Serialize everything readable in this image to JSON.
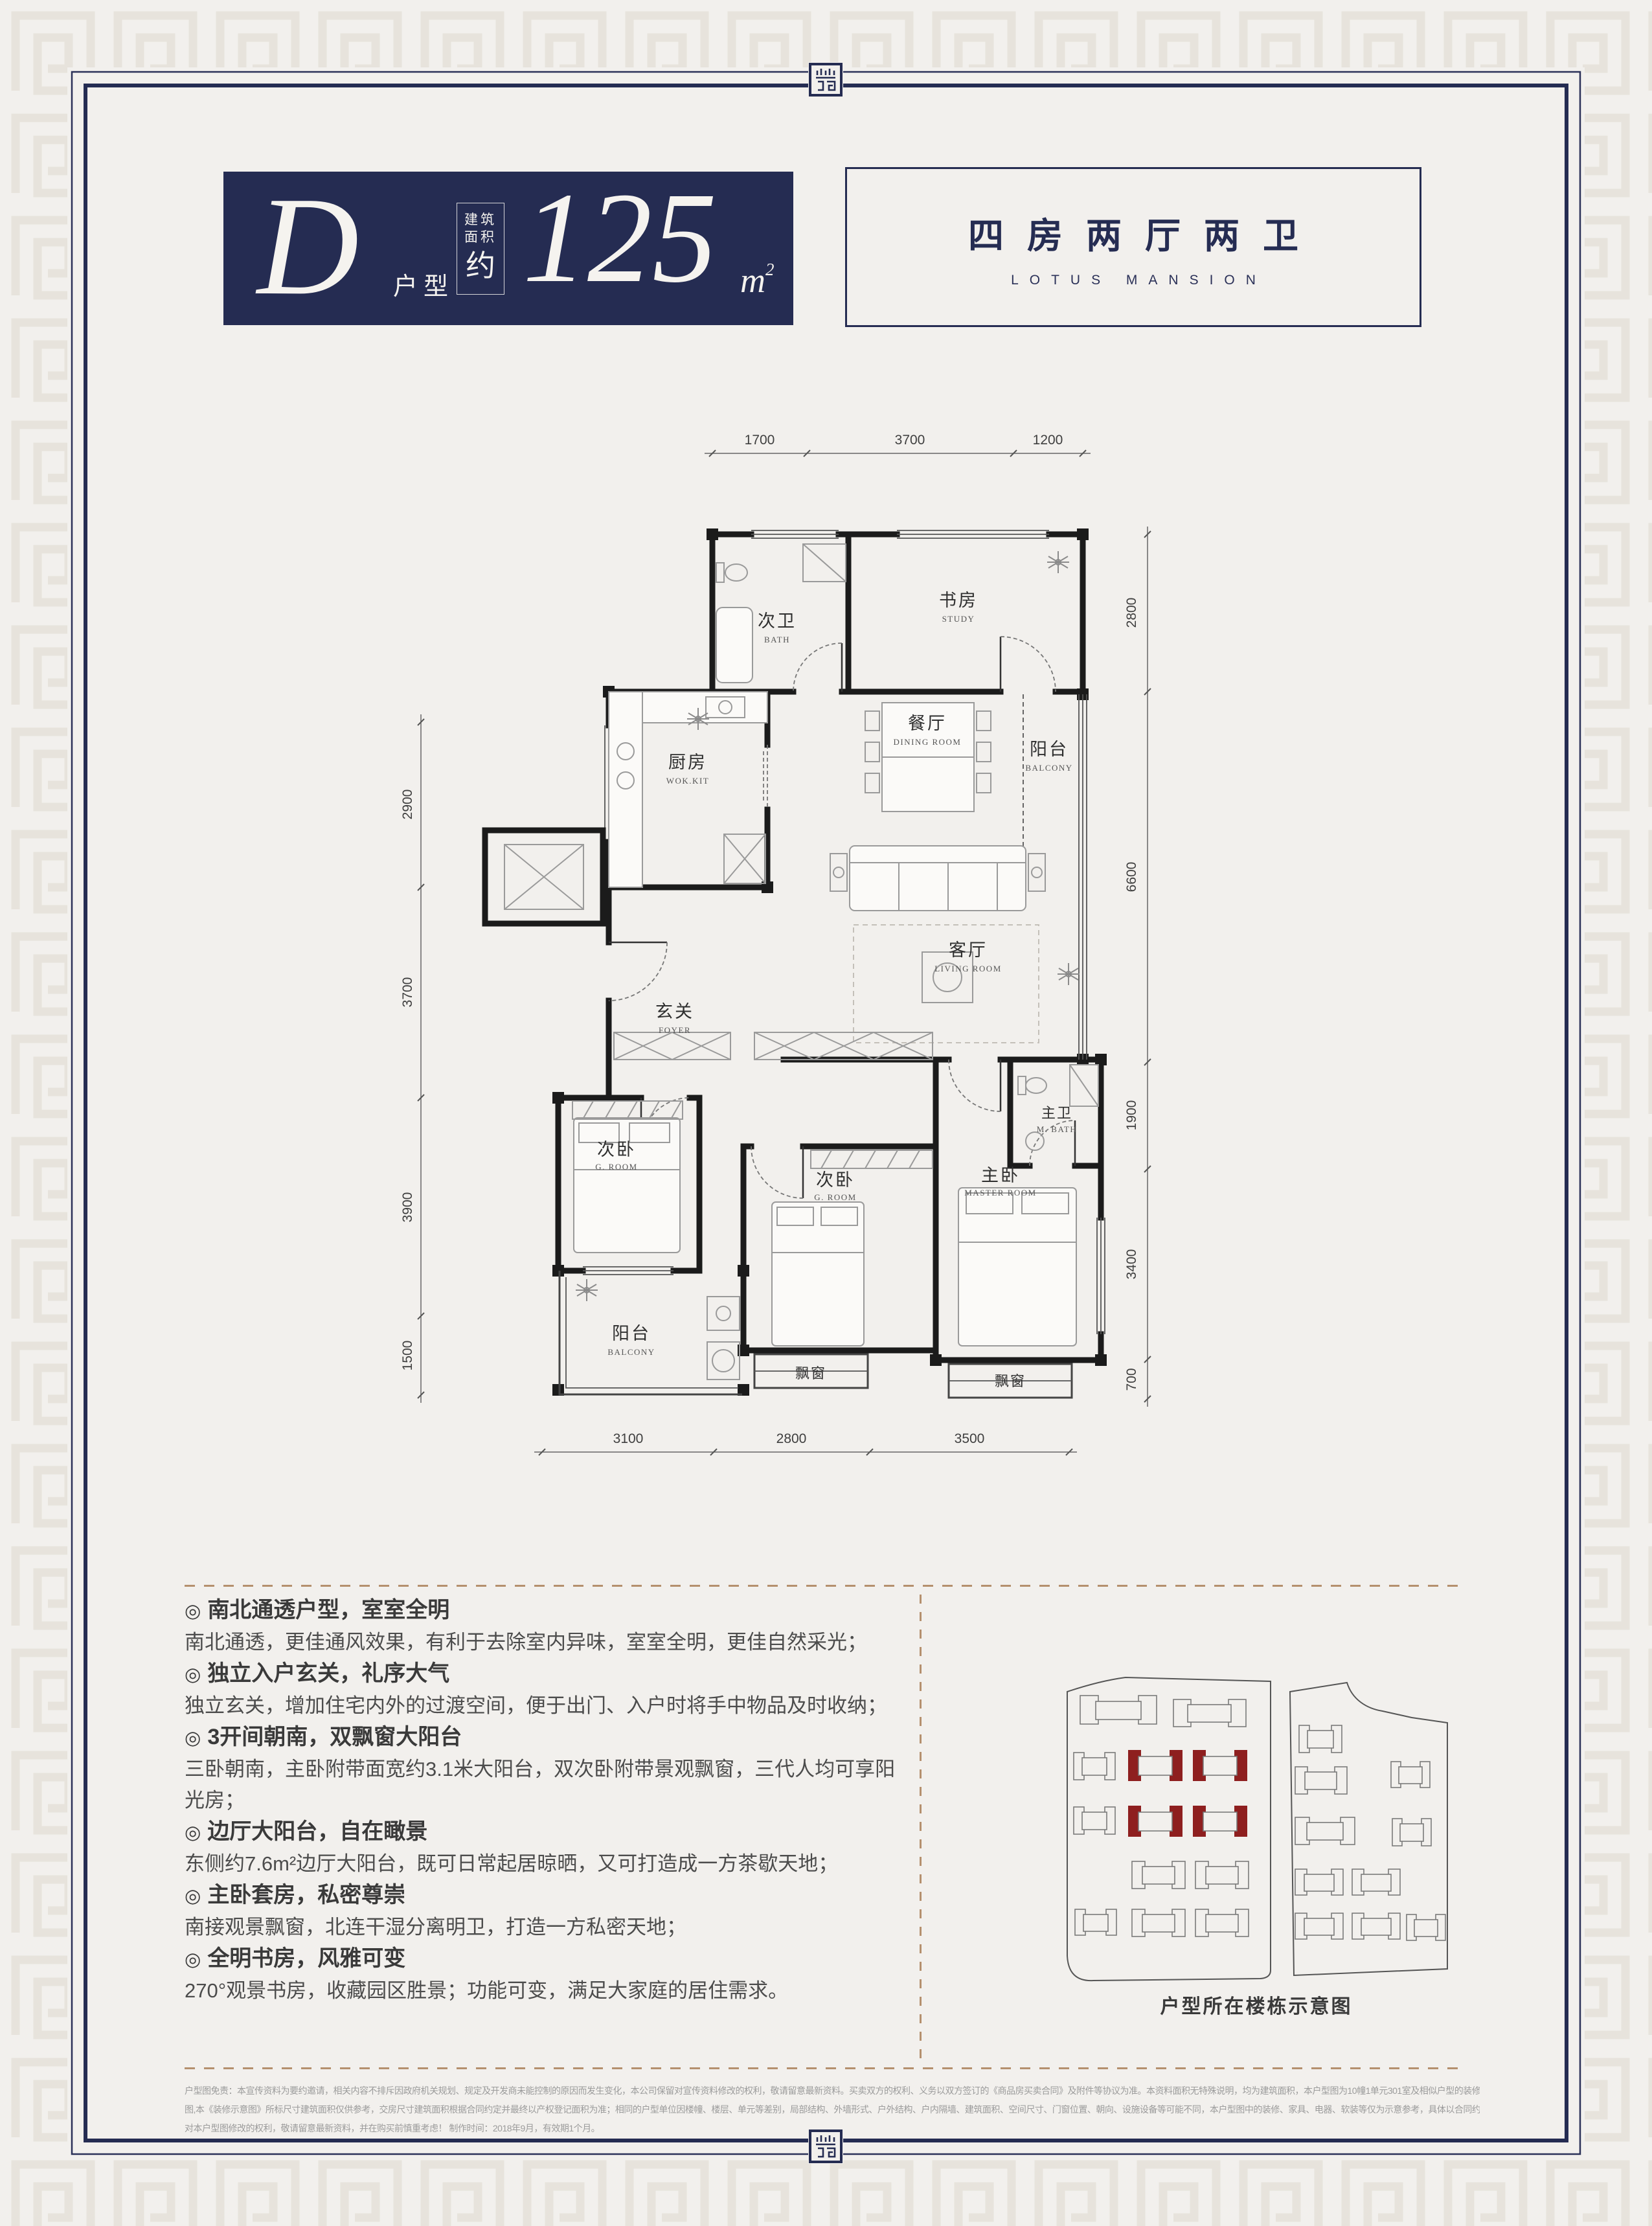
{
  "colors": {
    "navy": "#252c52",
    "page_bg": "#f2f0ed",
    "pattern": "#e7e3dc",
    "highlight_red": "#8e1f1f",
    "dash_tan": "#b5906e"
  },
  "header": {
    "unit_letter": "D",
    "unit_label": "户型",
    "area_box": {
      "line1": "建筑",
      "line2": "面积",
      "line3": "约"
    },
    "area_value": "125",
    "area_unit_base": "m",
    "area_unit_sup": "2",
    "layout_title": "四房两厅两卫",
    "layout_subtitle": "LOTUS MANSION"
  },
  "plan": {
    "rooms": [
      {
        "cn": "次卫",
        "en": "BATH"
      },
      {
        "cn": "书房",
        "en": "STUDY"
      },
      {
        "cn": "厨房",
        "en": "WOK.KIT"
      },
      {
        "cn": "餐厅",
        "en": "DINING ROOM"
      },
      {
        "cn": "阳台",
        "en": "BALCONY"
      },
      {
        "cn": "客厅",
        "en": "LIVING ROOM"
      },
      {
        "cn": "玄关",
        "en": "FOYER"
      },
      {
        "cn": "次卧",
        "en": "G. ROOM"
      },
      {
        "cn": "次卧",
        "en": "G. ROOM"
      },
      {
        "cn": "主卧",
        "en": "MASTER ROOM"
      },
      {
        "cn": "主卫",
        "en": "M. BATH"
      },
      {
        "cn": "阳台",
        "en": "BALCONY"
      }
    ],
    "bay_window": "飘窗",
    "dims": {
      "top": [
        "1700",
        "3700",
        "1200"
      ],
      "right": [
        "2800",
        "6600",
        "1900",
        "3400",
        "700"
      ],
      "bottom": [
        "3100",
        "2800",
        "3500"
      ],
      "left": [
        "2900",
        "3700",
        "3900",
        "1500"
      ]
    }
  },
  "marker": "◎",
  "features": [
    {
      "heading": "南北通透户型，室室全明",
      "body": "南北通透，更佳通风效果，有利于去除室内异味，室室全明，更佳自然采光；"
    },
    {
      "heading": "独立入户玄关，礼序大气",
      "body": "独立玄关，增加住宅内外的过渡空间，便于出门、入户时将手中物品及时收纳；"
    },
    {
      "heading": "3开间朝南，双飘窗大阳台",
      "body": "三卧朝南，主卧附带面宽约3.1米大阳台，双次卧附带景观飘窗，三代人均可享阳光房；"
    },
    {
      "heading": "边厅大阳台，自在瞰景",
      "body": "东侧约7.6m²边厅大阳台，既可日常起居晾晒，又可打造成一方茶歇天地；"
    },
    {
      "heading": "主卧套房，私密尊崇",
      "body": "南接观景飘窗，北连干湿分离明卫，打造一方私密天地；"
    },
    {
      "heading": "全明书房，风雅可变",
      "body": "270°观景书房，收藏园区胜景；功能可变，满足大家庭的居住需求。"
    }
  ],
  "site": {
    "caption": "户型所在楼栋示意图"
  },
  "disclaimer": {
    "line1": "户型图免责：本宣传资料为要约邀请，相关内容不排斥因政府机关规划、规定及开发商未能控制的原因而发生变化，本公司保留对宣传资料修改的权利，敬请留意最新资料。买卖双方的权利、义务以双方签订的《商品房买卖合同》及附件等协议为准。本资料面积无特殊说明，均为建筑面积，本户型图为10幢1单元301室及相似户型的装修及家具布置建议",
    "line2": "图,本《装修示意图》所标尺寸建筑面积仅供参考，交房尺寸建筑面积根据合同约定并最终以产权登记面积为准；相同的户型单位因楼幢、楼层、单元等差别，局部结构、外墙形式、户外结构、户内隔墙、建筑面积、空间尺寸、门窗位置、朝向、设施设备等可能不同，本户型图中的装修、家具、电器、软装等仅为示意参考，具体以合同约定为准。本公司保留",
    "line3": "对本户型图修改的权利，敬请留意最新资料，并在购买前慎重考虑！ 制作时间：2018年9月，有效期1个月。"
  }
}
